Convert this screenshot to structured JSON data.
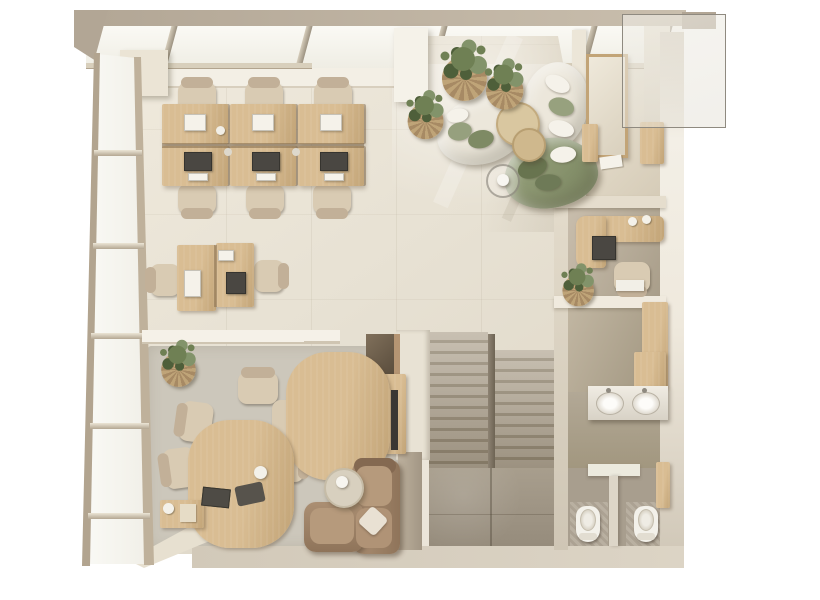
{
  "scene": {
    "description": "Top-down 3D rendered floor plan of a modern office loft in a beige / light-oak palette",
    "view": "orthographic top-down render, no text labels",
    "areas": [
      {
        "name": "open-office",
        "contents": "six light-oak desks in a 3x2 back-to-back cluster with beige task chairs, laptops and monitors"
      },
      {
        "name": "duo-workstation",
        "contents": "two back-to-back desks with one white and one dark monitor and two task chairs"
      },
      {
        "name": "lounge",
        "contents": "two cream curved kidney sofas, one sage-green curved sofa, two round oak coffee tables, glass side table with white ball lamp, potted plants in woven baskets, white column"
      },
      {
        "name": "meeting-area",
        "contents": "freeform oak table of two offset lobes, six beige fabric chairs, desk lamp, dark laptop, oak side cabinet with kettle, large grey rug, potted plant on wall ledge"
      },
      {
        "name": "tv-corner",
        "contents": "L-shaped brown fabric sofa with cream pillow, woven pouf side table with ball lamp, wall-mounted oak media panel with TV"
      },
      {
        "name": "private-office",
        "contents": "L-shaped oak desk with monitor and two mugs, task chair, corner plant, oak wall shelves, oak-framed wardrobe, loose papers"
      },
      {
        "name": "locker-room",
        "contents": "tall oak locker cabinet, white wall shelf with small item"
      },
      {
        "name": "washroom",
        "contents": "white vanity counter with two oval basins and faucets, oak wall cabinet"
      },
      {
        "name": "wc",
        "contents": "two toilet stalls with white toilets, T-shaped partition, oak door panel, mosaic tile floors"
      },
      {
        "name": "stairwell",
        "contents": "double-flight stone staircase with centre divider, white stringer wall and stone landing"
      },
      {
        "name": "envelope",
        "contents": "angled glazed wall on the left, glazed roof strip on top, beige perimeter walls, frosted glass panel overlapping the top-right corner"
      }
    ],
    "counts": {
      "desks": 9,
      "task_chairs": 9,
      "meeting_chairs": 6,
      "curved_sofas": 3,
      "brown_sofa": 1,
      "coffee_tables": 2,
      "plants": 5,
      "toilets": 2,
      "basins": 2,
      "stair_flights": 2
    }
  },
  "palette": {
    "bg": "#ffffff",
    "wall_top": "#b2a695",
    "wall": "#c9bead",
    "wall_dark": "#a2967f",
    "wall_light": "#efe9dd",
    "cream": "#f3efe5",
    "glass": "#f6f4ed",
    "frame": "#b2a48f",
    "frame_light": "#d8cfbc",
    "floor": "#eae4d7",
    "floor_warm": "#ddd4c2",
    "floor_dark": "#aca186",
    "rug": "#ccc7bb",
    "wood": "#d9bd93",
    "wood_dark": "#c2a477",
    "wood_deep": "#a78a64",
    "stone": "#bcb2a1",
    "stone_dark": "#998e7a",
    "landing": "#a79d8c",
    "sofa_cream": "#ece7db",
    "green": "#8d9873",
    "green_dark": "#6e7a57",
    "brown": "#9b7f63",
    "brown_light": "#b2957a",
    "brown_dark": "#846951",
    "chair": "#d9cbb3",
    "chair_dark": "#c2b098",
    "white": "#f5f2ea",
    "screen": "#4a4742",
    "metal": "#8f8a80",
    "plant": "#6f8054",
    "plant_dark": "#4e5f3a",
    "plant_light": "#82936a",
    "basket": "#bfa478",
    "niche": "#6b5a47",
    "wc_floor": "#a89e8e",
    "tile_dark": "#aca293",
    "tile_light": "#b9b0a1"
  }
}
